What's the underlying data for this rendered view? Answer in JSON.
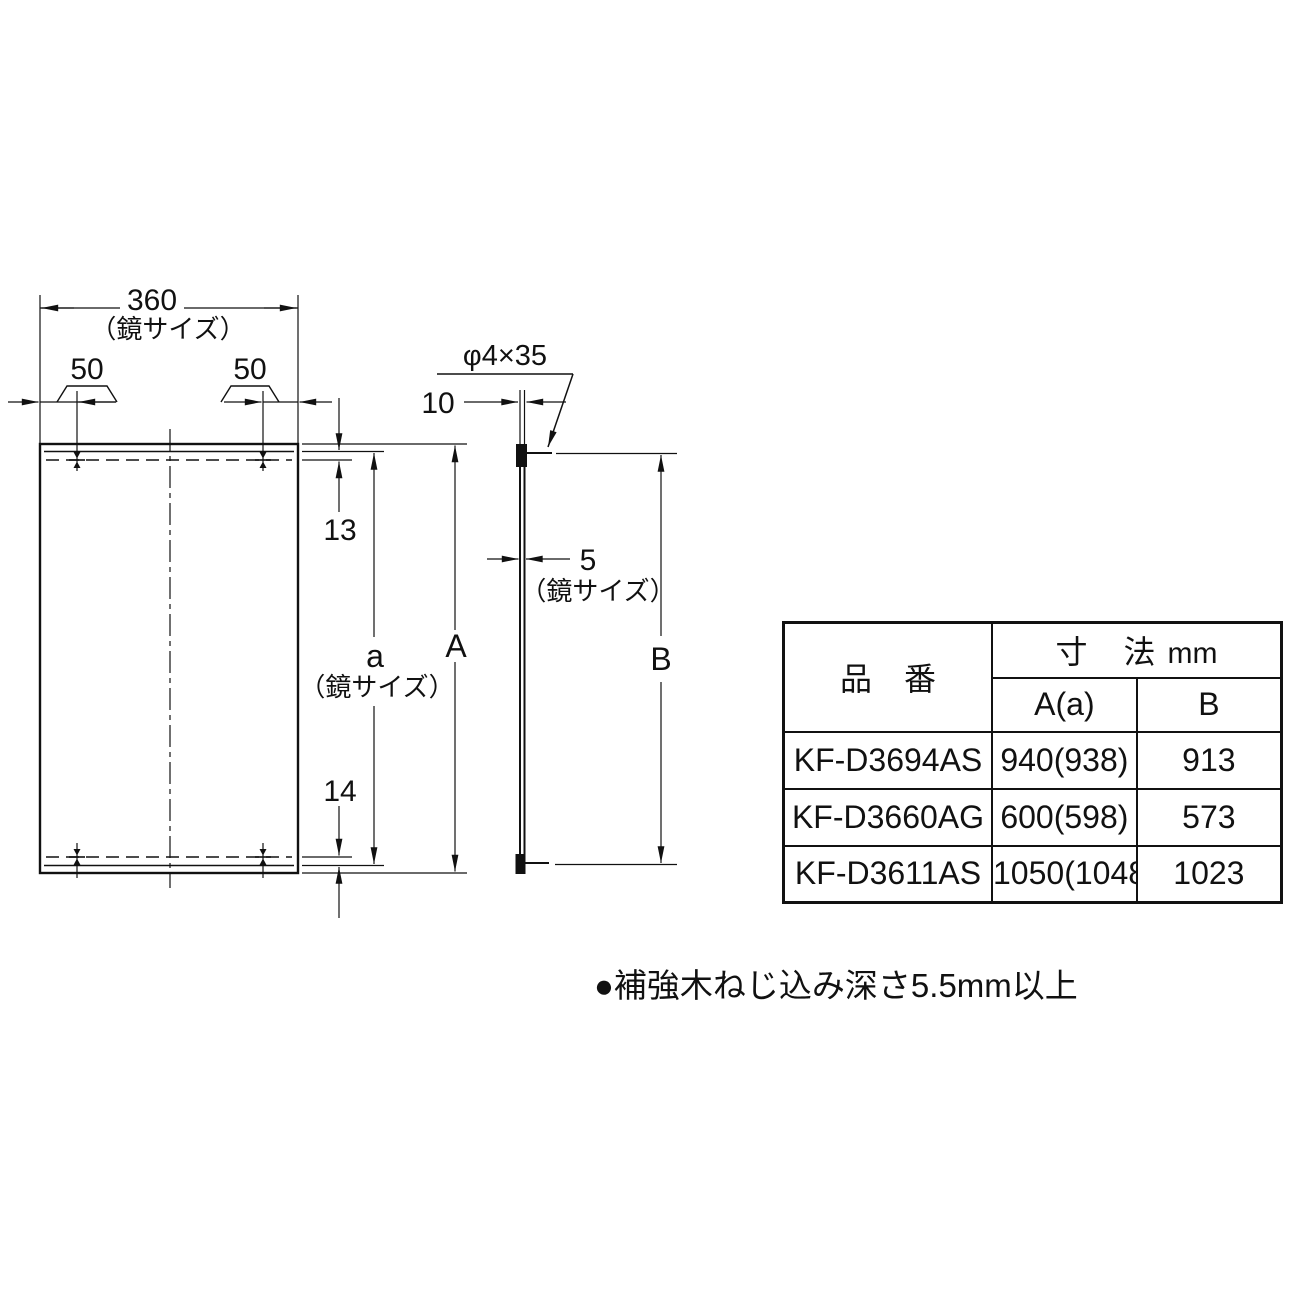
{
  "front_view": {
    "width": "360",
    "width_note": "（鏡サイズ）",
    "offset_left": "50",
    "offset_right": "50",
    "top_inset": "13",
    "bottom_inset": "14",
    "glass_height": "a",
    "glass_height_note": "（鏡サイズ）",
    "overall_height": "A"
  },
  "side_view": {
    "screw_spec": "φ4×35",
    "projection": "10",
    "thickness": "5",
    "thickness_note": "（鏡サイズ）",
    "height": "B"
  },
  "table": {
    "product_header": "品　番",
    "dim_header": "寸　法",
    "dim_unit": "mm",
    "col_a": "A(a)",
    "col_b": "B",
    "rows": [
      {
        "product": "KF-D3694AS",
        "a": "940(938)",
        "b": "913"
      },
      {
        "product": "KF-D3660AG",
        "a": "600(598)",
        "b": "573"
      },
      {
        "product": "KF-D3611AS",
        "a": "1050(1048)",
        "b": "1023"
      }
    ]
  },
  "note": "●補強木ねじ込み深さ5.5mm以上"
}
